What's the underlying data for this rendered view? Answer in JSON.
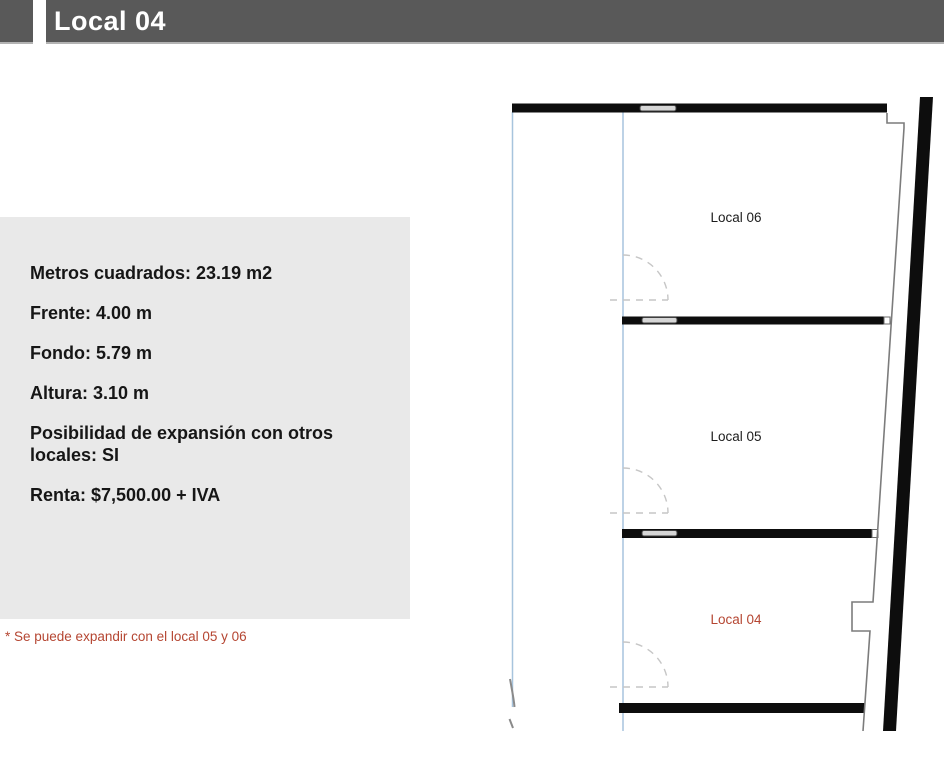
{
  "header": {
    "title": "Local 04"
  },
  "info_panel": {
    "items": [
      "Metros cuadrados: 23.19 m2",
      "Frente: 4.00 m",
      "Fondo: 5.79 m",
      "Altura: 3.10 m",
      "Posibilidad de expansión con otros locales: SI",
      "Renta: $7,500.00 + IVA"
    ]
  },
  "footnote": "* Se puede expandir con el local 05 y 06",
  "floorplan": {
    "rooms": [
      {
        "label": "Local 06",
        "highlighted": false
      },
      {
        "label": "Local 05",
        "highlighted": false
      },
      {
        "label": "Local 04",
        "highlighted": true
      }
    ]
  },
  "colors": {
    "header_bar": "#595959",
    "panel_bg": "#e9e9e9",
    "accent_red": "#b54632",
    "wall_black": "#0d0d0d",
    "guide_blue": "#a7c4dd"
  }
}
